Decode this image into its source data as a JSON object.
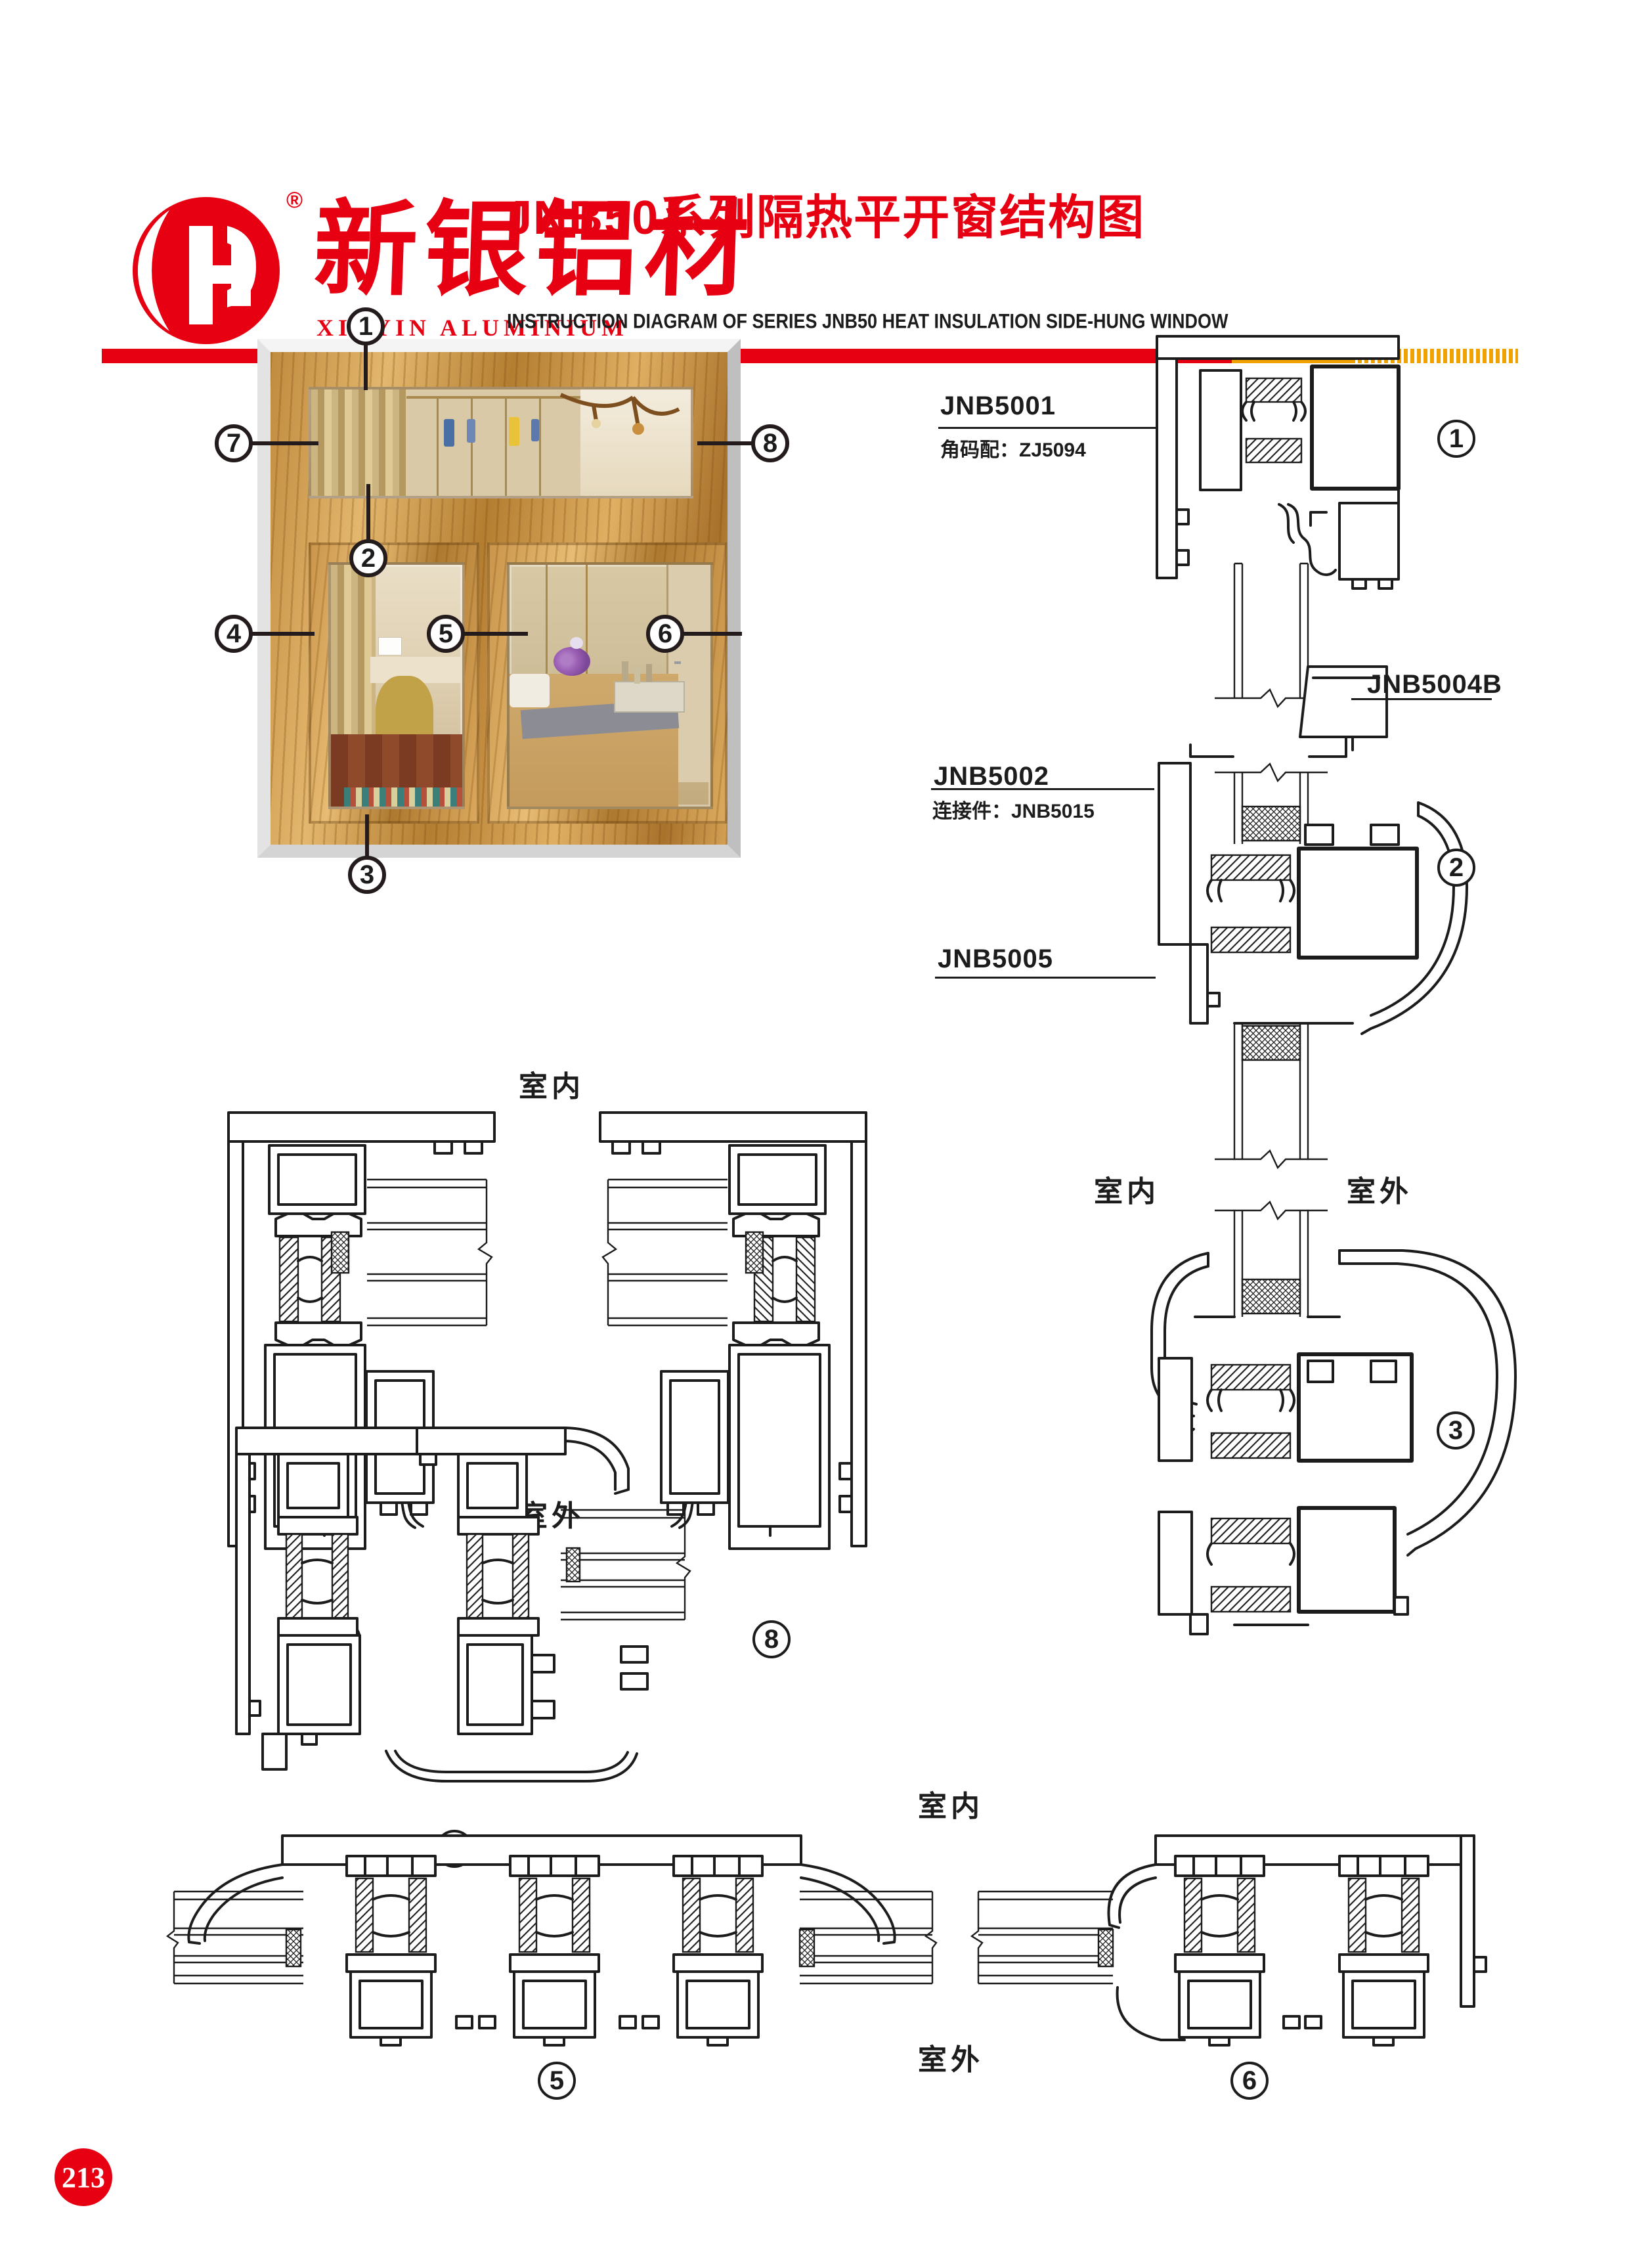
{
  "header": {
    "brand_cn": "新银铝材",
    "brand_en": "XINYIN ALUMINIUM",
    "registered": "®",
    "title_cn": "JNB50系列隔热平开窗结构图",
    "title_en": "INSTRUCTION DIAGRAM OF SERIES JNB50 HEAT INSULATION SIDE-HUNG WINDOW",
    "accent_red": "#e60012",
    "accent_yellow": "#f0a300"
  },
  "nums": {
    "n1": "1",
    "n2": "2",
    "n3": "3",
    "n4": "4",
    "n5": "5",
    "n6": "6",
    "n7": "7",
    "n8": "8"
  },
  "labels": {
    "l1": {
      "code": "JNB5001",
      "note": "角码配：ZJ5094"
    },
    "l2": {
      "code": "JNB5002",
      "note": "连接件：JNB5015"
    },
    "l4b": {
      "code": "JNB5004B"
    },
    "l5": {
      "code": "JNB5005"
    }
  },
  "loc": {
    "in": "室内",
    "out": "室外"
  },
  "page_number": "213"
}
